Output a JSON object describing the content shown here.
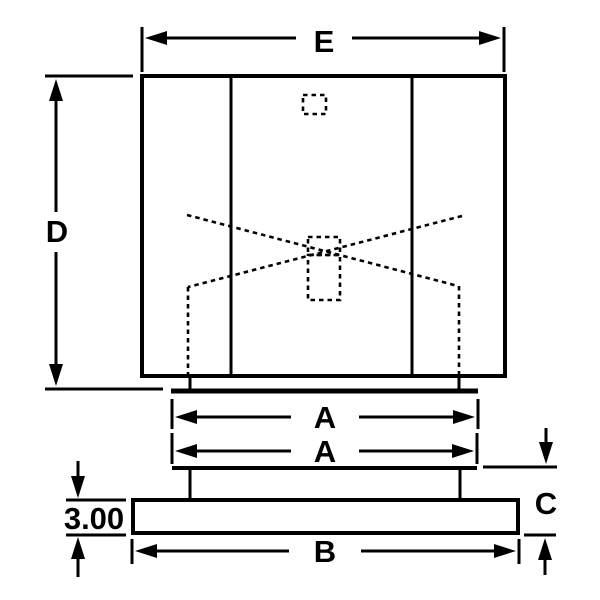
{
  "diagram": {
    "type": "technical-dimension-drawing",
    "description": "Front-view outline drawing of a unit on a base plate with dimension callouts",
    "colors": {
      "line": "#000000",
      "background": "#ffffff"
    },
    "dimensions": {
      "top_width": {
        "label": "E",
        "orientation": "horizontal",
        "measures": "overall body width"
      },
      "body_height": {
        "label": "D",
        "orientation": "vertical",
        "measures": "overall body height"
      },
      "upper_flange_width": {
        "label": "A",
        "orientation": "horizontal",
        "measures": "flange width"
      },
      "lower_flange_width": {
        "label": "A",
        "orientation": "horizontal",
        "measures": "mounting plate width"
      },
      "base_width": {
        "label": "B",
        "orientation": "horizontal",
        "measures": "base plate width"
      },
      "base_height": {
        "label": "C",
        "orientation": "vertical",
        "measures": "base assembly height"
      },
      "base_thickness": {
        "label": "3.00",
        "orientation": "vertical",
        "measures": "base plate thickness"
      }
    }
  }
}
